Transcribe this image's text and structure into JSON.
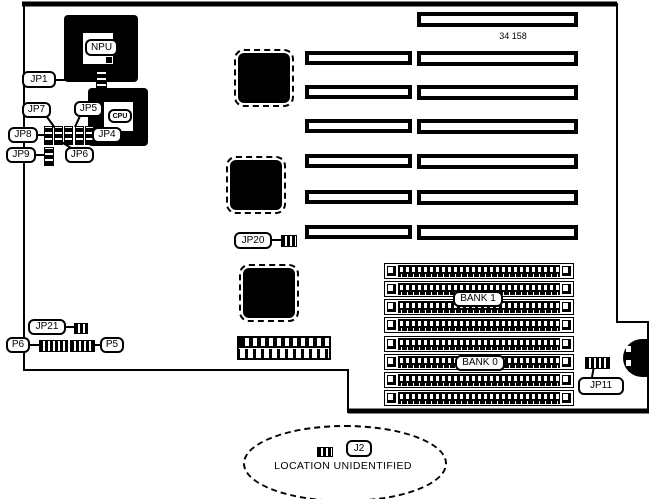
{
  "board": {
    "part_number": "34 158",
    "note": "LOCATION UNIDENTIFIED",
    "processor": {
      "npu": "NPU",
      "cpu": "CPU"
    },
    "memory": {
      "bank1": "BANK 1",
      "bank0": "BANK 0"
    },
    "connectors": {
      "jp1": "JP1",
      "jp4": "JP4",
      "jp5": "JP5",
      "jp6": "JP6",
      "jp7": "JP7",
      "jp8": "JP8",
      "jp9": "JP9",
      "jp11": "JP11",
      "jp20": "JP20",
      "jp21": "JP21",
      "p5": "P5",
      "p6": "P6",
      "j2": "J2"
    },
    "colors": {
      "ink": "#000000",
      "paper": "#ffffff"
    }
  }
}
